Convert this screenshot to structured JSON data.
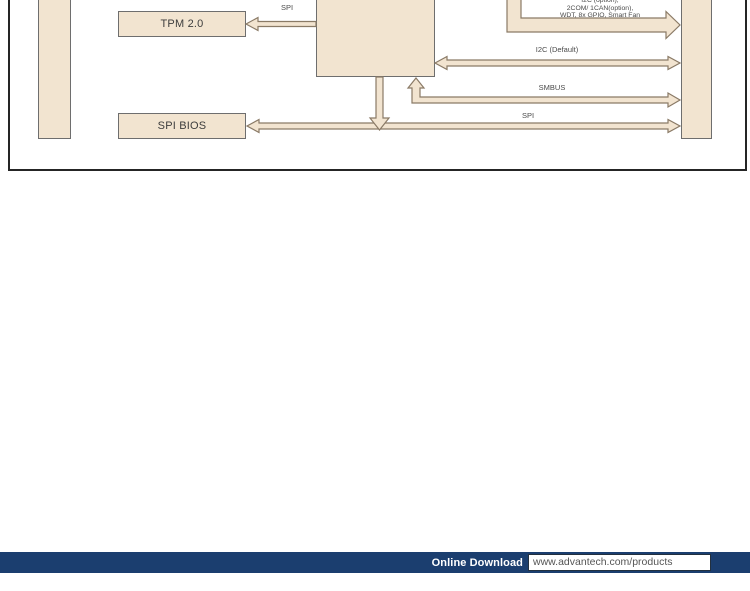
{
  "diagram": {
    "blocks": {
      "tpm": {
        "label": "TPM 2.0"
      },
      "spi_bios": {
        "label": "SPI BIOS"
      }
    },
    "bus_labels": {
      "spi_tpm": "SPI",
      "option_lines": [
        "I2C (option),",
        "2COM/ 1CAN(option),",
        "WDT, 8x GPIO, Smart Fan"
      ],
      "i2c_default": "I2C (Default)",
      "smbus": "SMBUS",
      "spi_bios": "SPI"
    },
    "colors": {
      "block_fill": "#f2e4d0",
      "block_border": "#6e6e6e",
      "arrow_outline": "#8a7a66",
      "frame_border": "#252525"
    }
  },
  "footer": {
    "download_label": "Online Download",
    "download_url": "www.advantech.com/products",
    "bar_color": "#1b3e6f"
  }
}
